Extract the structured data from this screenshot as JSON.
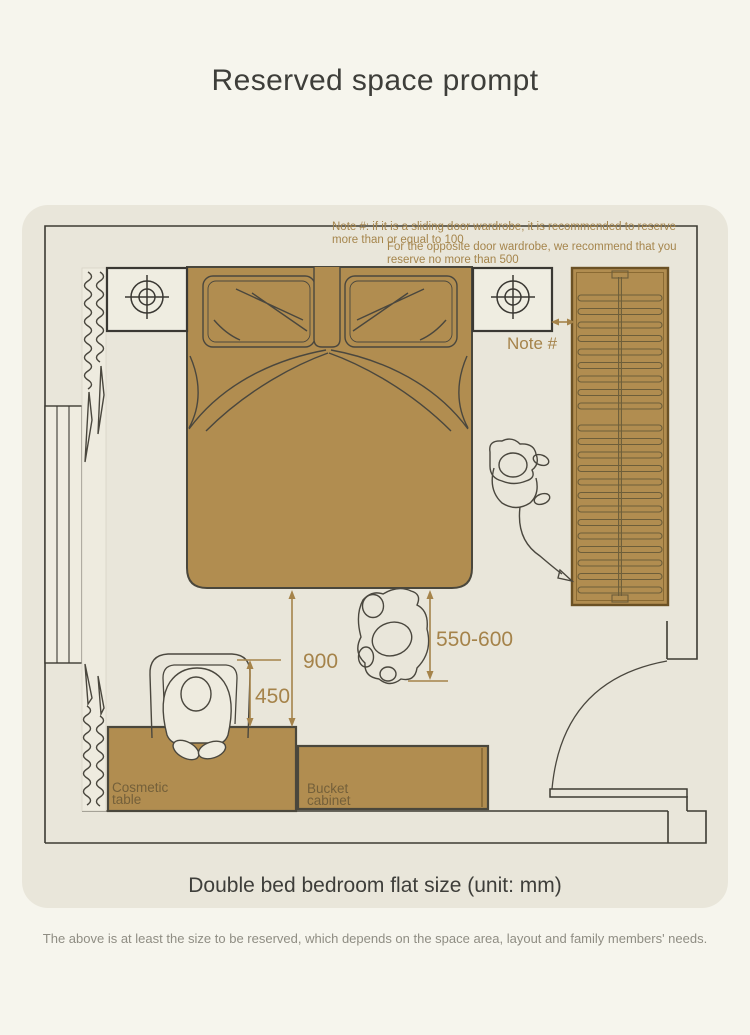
{
  "page": {
    "title": "Reserved space prompt",
    "caption": "Double bed bedroom flat size (unit: mm)",
    "footer": "The above is at least the size to be reserved, which depends on the space area, layout and family members' needs."
  },
  "notes": {
    "sliding_door_line1": "Note #: if it is a sliding door wardrobe, it is recommended to reserve",
    "sliding_door_line2": "more than or equal to 100",
    "opposite_door_line1": "For the opposite door wardrobe, we recommend that you",
    "opposite_door_line2": "reserve no more than 500",
    "note_ref": "Note #"
  },
  "dimensions": {
    "bed_to_table": "900",
    "stool_depth": "450",
    "wardrobe_walkway": "550-600"
  },
  "furniture": {
    "cosmetic_table": {
      "line1": "Cosmetic",
      "line2": "table"
    },
    "bucket_cabinet": {
      "line1": "Bucket",
      "line2": "cabinet"
    }
  },
  "colors": {
    "page_bg": "#f6f5ed",
    "card_bg": "#e9e6da",
    "furniture_fill": "#b18d50",
    "furniture_border": "#6b5124",
    "accent_gold": "#a5834a",
    "label_brown": "#74603a",
    "wall_line": "#3d3b33",
    "title_text": "#3e3e3a",
    "footer_text": "#8f8d83"
  }
}
